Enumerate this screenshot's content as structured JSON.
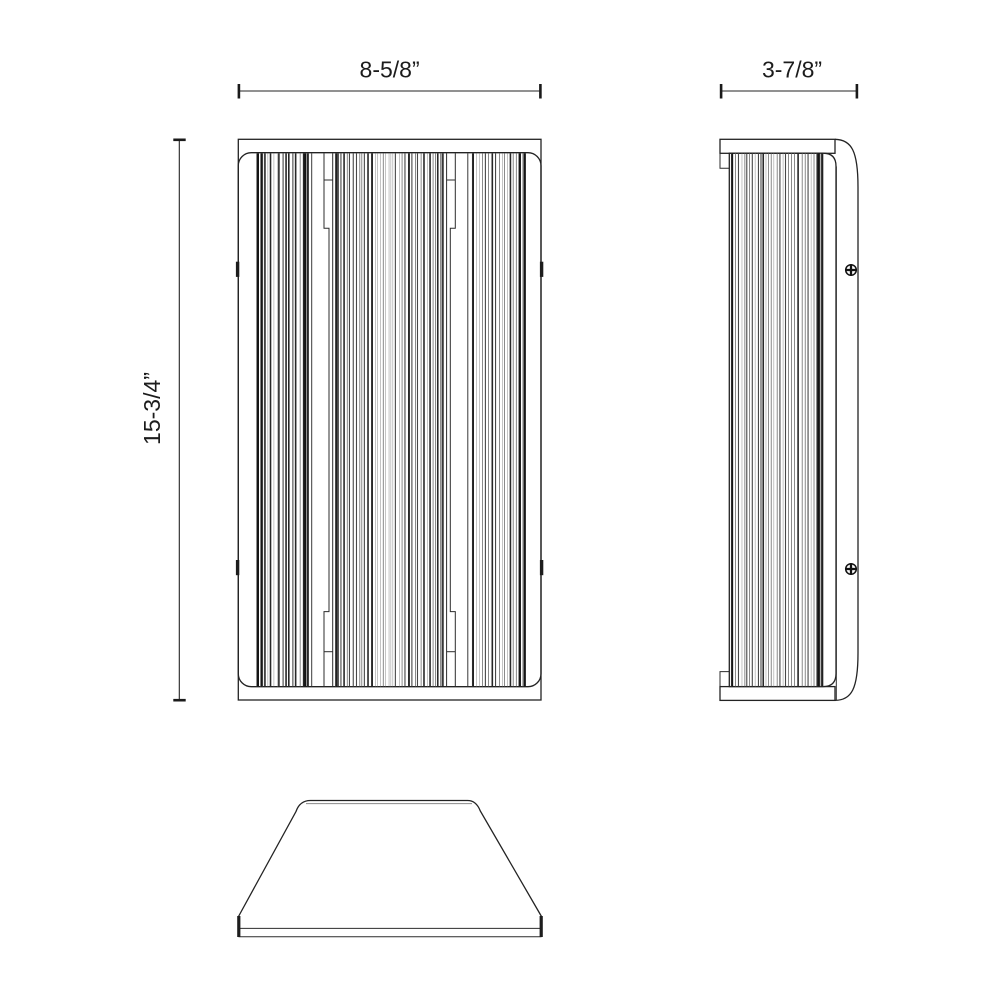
{
  "drawing": {
    "background": "#ffffff",
    "line_color": "#232323",
    "dimensions": {
      "width_label": "8-5/8”",
      "height_label": "15-3/4”",
      "depth_label": "3-7/8”"
    }
  },
  "geometry": {
    "stripe_groups": [
      {
        "name": "front-left",
        "x0": 257.0,
        "x1": 308.5,
        "y0": 153.4,
        "y1": 686.4,
        "seed": 7,
        "accents": [
          {
            "x": 257.9,
            "w": 2.2
          },
          {
            "x": 261.5,
            "w": 1.4
          },
          {
            "x": 305.3,
            "w": 2.3
          },
          {
            "x": 308.0,
            "w": 1.6
          }
        ]
      },
      {
        "name": "front-middle",
        "x0": 335.5,
        "x1": 444.0,
        "y0": 153.4,
        "y1": 686.4,
        "seed": 13,
        "accents": [
          {
            "x": 336.2,
            "w": 1.5
          },
          {
            "x": 372.0,
            "w": 1.7
          },
          {
            "x": 409.0,
            "w": 1.7
          },
          {
            "x": 442.9,
            "w": 1.5
          }
        ]
      },
      {
        "name": "front-right",
        "x0": 472.5,
        "x1": 525.5,
        "y0": 153.4,
        "y1": 686.4,
        "seed": 23,
        "accents": [
          {
            "x": 473.2,
            "w": 1.5
          },
          {
            "x": 519.8,
            "w": 2.3
          },
          {
            "x": 524.6,
            "w": 2.0
          }
        ]
      },
      {
        "name": "side",
        "x0": 731.5,
        "x1": 824.5,
        "y0": 153.4,
        "y1": 686.4,
        "seed": 31,
        "accents": [
          {
            "x": 732.3,
            "w": 1.7
          },
          {
            "x": 818.6,
            "w": 2.6
          },
          {
            "x": 822.0,
            "w": 1.5
          }
        ]
      }
    ],
    "standalone_lines": [
      {
        "x": 311.7,
        "y0": 153.4,
        "y1": 686.4
      },
      {
        "x": 467.8,
        "y0": 153.4,
        "y1": 686.4
      }
    ]
  }
}
